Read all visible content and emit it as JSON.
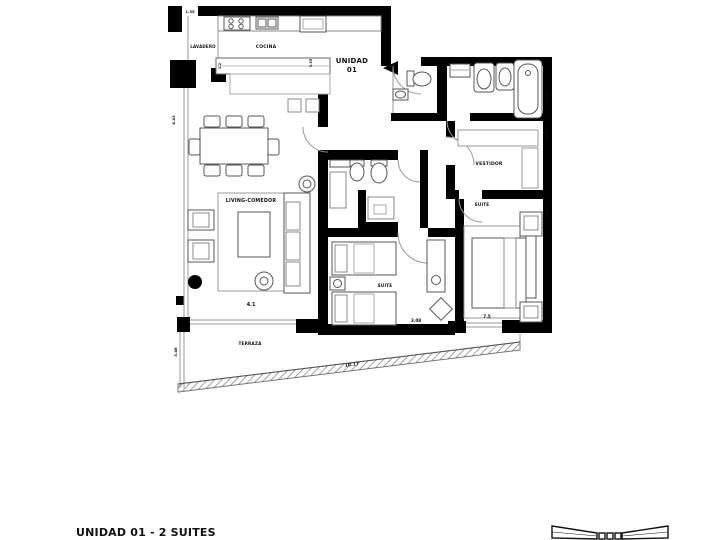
{
  "plan": {
    "unit": {
      "line1": "UNIDAD",
      "line2": "01"
    },
    "rooms": {
      "lavadero": "LAVADERO",
      "cocina": "COCINA",
      "living_comedor": "LIVING-COMEDOR",
      "suite_2": "SUITE",
      "suite_main": "SUITE",
      "vestidor": "VESTIDOR",
      "terraza": "TERRAZA"
    },
    "dimensions": {
      "d_top_left": "1.35",
      "d_left_wall": "4.43",
      "d_kitchen_left": "1.2",
      "d_kitchen_right": "5.35",
      "d_living": "4.1",
      "d_suite2": "3.08",
      "d_suite_main": "7.5",
      "d_terrace_left": "3.48",
      "d_terrace_edge": "10.17",
      "d_bath_right": "2.9",
      "d_vestidor_right": "4.35",
      "d_suite_right": "4.30"
    },
    "colors": {
      "wall": "#000000",
      "furniture_line": "#555555",
      "light_line": "#999999"
    }
  },
  "footer": {
    "caption": "UNIDAD 01 - 2 SUITES"
  }
}
